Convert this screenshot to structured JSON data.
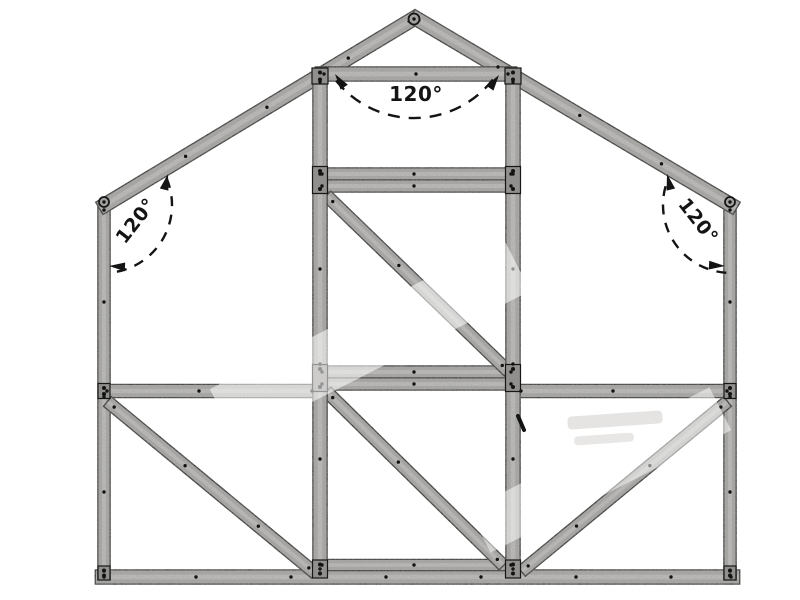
{
  "meta": {
    "type": "technical-frame-diagram",
    "subject": "gable-end greenhouse frame elevation",
    "background_color": "#ffffff"
  },
  "canvas": {
    "width": 800,
    "height": 600
  },
  "style": {
    "member_fill": "#a9a8a6",
    "member_edge": "#161616",
    "member_highlight": "#c2c1bf",
    "plate_fill": "#908f8d",
    "rivet_color": "#131313",
    "hub_fill": "#a3a2a0",
    "annotation_color": "#141414",
    "watermark_band_color": "#ffffff",
    "watermark_smudge_color": "#cbcac8"
  },
  "members": [
    {
      "name": "bottom-sill",
      "x1": 96,
      "y1": 577,
      "x2": 739,
      "y2": 577,
      "w": 13
    },
    {
      "name": "wall-left",
      "x1": 104,
      "y1": 202,
      "x2": 104,
      "y2": 579,
      "w": 11
    },
    {
      "name": "wall-right",
      "x1": 730,
      "y1": 202,
      "x2": 730,
      "y2": 579,
      "w": 11
    },
    {
      "name": "rafter-left",
      "x1": 100,
      "y1": 208,
      "x2": 418,
      "y2": 16,
      "w": 13
    },
    {
      "name": "rafter-right",
      "x1": 412,
      "y1": 16,
      "x2": 736,
      "y2": 208,
      "w": 13
    },
    {
      "name": "mid-rail-left",
      "x1": 99,
      "y1": 391,
      "x2": 320,
      "y2": 391,
      "w": 12
    },
    {
      "name": "mid-rail-right",
      "x1": 513,
      "y1": 391,
      "x2": 735,
      "y2": 391,
      "w": 12
    },
    {
      "name": "door-threshold",
      "x1": 314,
      "y1": 565,
      "x2": 519,
      "y2": 565,
      "w": 10
    },
    {
      "name": "mid-rail-center-upper",
      "x1": 314,
      "y1": 372,
      "x2": 519,
      "y2": 372,
      "w": 11
    },
    {
      "name": "mid-rail-center-lower",
      "x1": 314,
      "y1": 384,
      "x2": 519,
      "y2": 384,
      "w": 11
    },
    {
      "name": "door-head-rail-upper",
      "x1": 314,
      "y1": 174,
      "x2": 519,
      "y2": 174,
      "w": 11
    },
    {
      "name": "door-head-rail-lower",
      "x1": 314,
      "y1": 186,
      "x2": 519,
      "y2": 186,
      "w": 11
    },
    {
      "name": "brace-door-upper",
      "x1": 327,
      "y1": 196,
      "x2": 508,
      "y2": 371,
      "w": 11
    },
    {
      "name": "brace-door-lower",
      "x1": 327,
      "y1": 392,
      "x2": 503,
      "y2": 565,
      "w": 11
    },
    {
      "name": "brace-left-bay",
      "x1": 108,
      "y1": 402,
      "x2": 315,
      "y2": 573,
      "w": 11
    },
    {
      "name": "brace-right-bay",
      "x1": 727,
      "y1": 402,
      "x2": 522,
      "y2": 571,
      "w": 11
    },
    {
      "name": "door-post-left",
      "x1": 320,
      "y1": 74,
      "x2": 320,
      "y2": 577,
      "w": 13
    },
    {
      "name": "door-post-right",
      "x1": 513,
      "y1": 74,
      "x2": 513,
      "y2": 577,
      "w": 13
    },
    {
      "name": "collar-tie",
      "x1": 316,
      "y1": 74,
      "x2": 516,
      "y2": 74,
      "w": 13
    }
  ],
  "plates": [
    {
      "name": "plate-post-left-top",
      "cx": 320,
      "cy": 76,
      "w": 16,
      "h": 16
    },
    {
      "name": "plate-post-right-top",
      "cx": 513,
      "cy": 76,
      "w": 16,
      "h": 16
    },
    {
      "name": "plate-post-left-head",
      "cx": 320,
      "cy": 180,
      "w": 15,
      "h": 27
    },
    {
      "name": "plate-post-right-head",
      "cx": 513,
      "cy": 180,
      "w": 15,
      "h": 27
    },
    {
      "name": "plate-post-left-mid",
      "cx": 320,
      "cy": 378,
      "w": 15,
      "h": 27
    },
    {
      "name": "plate-post-right-mid",
      "cx": 513,
      "cy": 378,
      "w": 15,
      "h": 27
    },
    {
      "name": "plate-post-left-bottom",
      "cx": 320,
      "cy": 569,
      "w": 15,
      "h": 18
    },
    {
      "name": "plate-post-right-bottom",
      "cx": 513,
      "cy": 569,
      "w": 15,
      "h": 18
    },
    {
      "name": "plate-wall-left-mid",
      "cx": 104,
      "cy": 391,
      "w": 12,
      "h": 15
    },
    {
      "name": "plate-wall-right-mid",
      "cx": 730,
      "cy": 391,
      "w": 12,
      "h": 15
    },
    {
      "name": "plate-wall-left-bottom",
      "cx": 104,
      "cy": 573,
      "w": 12,
      "h": 14
    },
    {
      "name": "plate-wall-right-bottom",
      "cx": 730,
      "cy": 573,
      "w": 12,
      "h": 14
    }
  ],
  "hubs": [
    {
      "name": "hub-apex",
      "cx": 414,
      "cy": 19,
      "r": 5.5
    },
    {
      "name": "hub-eave-left",
      "cx": 104,
      "cy": 202,
      "r": 5
    },
    {
      "name": "hub-eave-right",
      "cx": 730,
      "cy": 202,
      "r": 5
    }
  ],
  "marks": [
    {
      "name": "latch-mark",
      "x1": 518,
      "y1": 416,
      "x2": 524,
      "y2": 430,
      "w": 4
    }
  ],
  "watermark": {
    "bands": [
      {
        "cx": 370,
        "cy": 340,
        "w": 330,
        "h": 58,
        "rot": -27,
        "opacity": 0.55
      },
      {
        "cx": 600,
        "cy": 470,
        "w": 270,
        "h": 48,
        "rot": -27,
        "opacity": 0.5
      }
    ],
    "smudges": [
      {
        "cx": 615,
        "cy": 420,
        "w": 95,
        "h": 13,
        "rot": -4,
        "opacity": 0.5
      },
      {
        "cx": 604,
        "cy": 439,
        "w": 60,
        "h": 9,
        "rot": -4,
        "opacity": 0.45
      }
    ]
  },
  "angle_annotations": [
    {
      "name": "angle-ridge",
      "label": "120°",
      "value_deg": 120,
      "vertex": {
        "x": 414,
        "y": 18
      },
      "radius": 100,
      "start_deg": 38,
      "end_deg": 142,
      "dash": "12 9",
      "text": {
        "x": 416,
        "y": 94,
        "rotation": 0,
        "size": 20
      },
      "arrows": [
        {
          "x": 499,
          "y": 75,
          "rot": -55
        },
        {
          "x": 335,
          "y": 74,
          "rot": 235
        }
      ]
    },
    {
      "name": "angle-eave-left",
      "label": "120°",
      "value_deg": 120,
      "vertex": {
        "x": 104,
        "y": 205
      },
      "radius": 68,
      "start_deg": -23,
      "end_deg": 86,
      "dash": "10 8.5",
      "text": {
        "x": 136,
        "y": 221,
        "rotation": -52,
        "size": 19
      },
      "arrows": [
        {
          "x": 168,
          "y": 174,
          "rot": -76
        },
        {
          "x": 109,
          "y": 266,
          "rot": 183
        }
      ]
    },
    {
      "name": "angle-eave-right",
      "label": "120°",
      "value_deg": 120,
      "vertex": {
        "x": 731,
        "y": 205
      },
      "radius": 68,
      "start_deg": 94,
      "end_deg": 203,
      "dash": "10 8.5",
      "text": {
        "x": 698,
        "y": 221,
        "rotation": 52,
        "size": 19
      },
      "arrows": [
        {
          "x": 667,
          "y": 174,
          "rot": -104
        },
        {
          "x": 725,
          "y": 266,
          "rot": 3
        }
      ]
    }
  ]
}
